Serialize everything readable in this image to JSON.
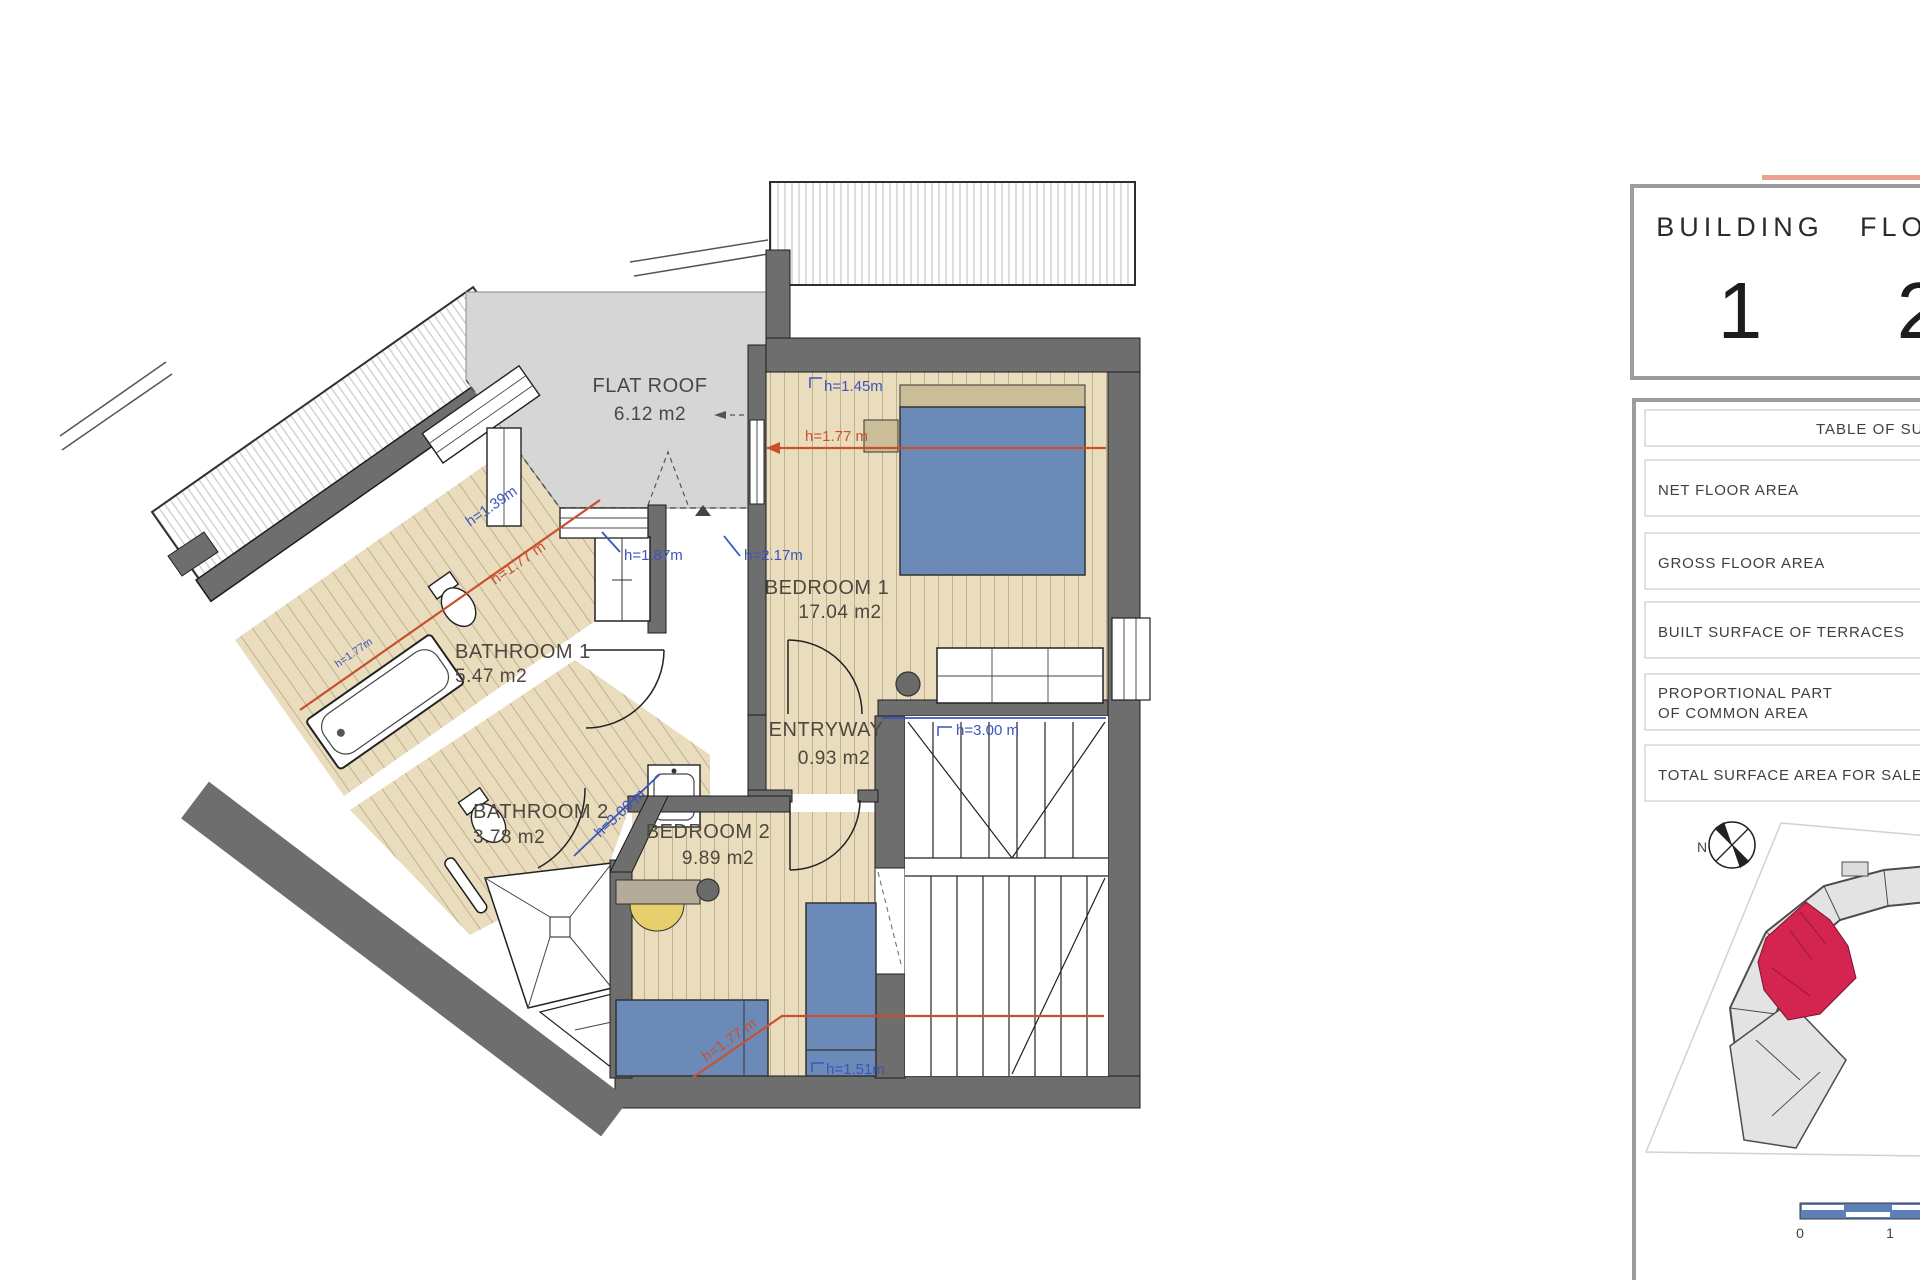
{
  "plan": {
    "rooms": {
      "flat_roof": {
        "name": "FLAT ROOF",
        "area": "6.12 m2"
      },
      "bedroom1": {
        "name": "BEDROOM 1",
        "area": "17.04 m2"
      },
      "bathroom1": {
        "name": "BATHROOM 1",
        "area": "5.47 m2"
      },
      "bathroom2": {
        "name": "BATHROOM 2",
        "area": "3.78 m2"
      },
      "bedroom2": {
        "name": "BEDROOM 2",
        "area": "9.89 m2"
      },
      "entryway": {
        "name": "ENTRYWAY",
        "area": "0.93 m2"
      }
    },
    "heights": {
      "h145": "h=1.45m",
      "h177_bed1": "h=1.77 m",
      "h139": "h=1.39m",
      "h177_bath1": "h=1.77 m",
      "h177_tub": "h=1.77m",
      "h187": "h=1.87m",
      "h217": "h=2.17m",
      "h300_stairs": "h=3.00 m",
      "h300_bed2": "h=3.00 m",
      "h177_bed2": "h=1.77 m",
      "h151": "h=1.51m"
    }
  },
  "panel": {
    "building": {
      "label": "BUILDING",
      "number": "1"
    },
    "floor": {
      "label": "FLOOR",
      "number": "2"
    },
    "table": {
      "header": "TABLE OF SURFACES",
      "rows": [
        {
          "label": "NET FLOOR AREA"
        },
        {
          "label": "GROSS FLOOR AREA"
        },
        {
          "label": "BUILT SURFACE OF TERRACES"
        },
        {
          "label": "PROPORTIONAL PART",
          "label2": "OF COMMON AREA"
        },
        {
          "label": "TOTAL SURFACE AREA FOR SALE"
        }
      ]
    },
    "compass": {
      "north": "N"
    },
    "scalebar": {
      "tick0": "0",
      "tick1": "1"
    }
  },
  "colors": {
    "wall": "#6e6e6e",
    "floor_wood": "#eaddbd",
    "flat_roof": "#d6d6d6",
    "furniture_blue": "#6c8ab8",
    "dim_blue": "#3b55bd",
    "dim_red": "#c8502f",
    "unit_highlight_red": "#d42550",
    "scalebar_blue": "#5d80b8",
    "accent_salmon": "#eba291"
  }
}
